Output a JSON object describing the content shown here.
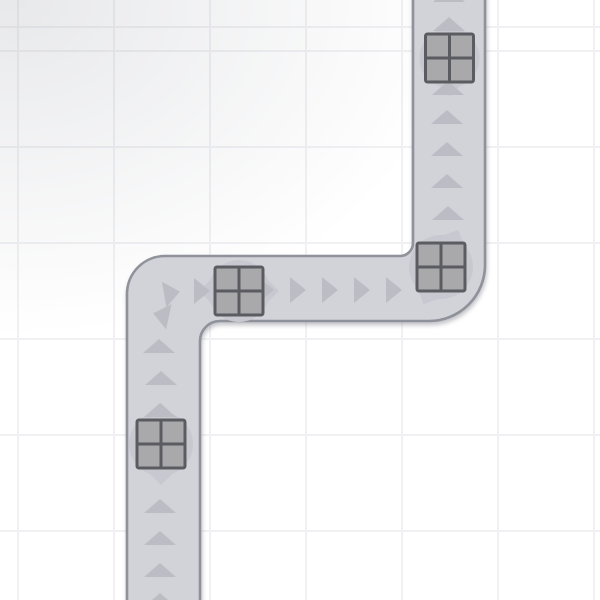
{
  "canvas": {
    "width": 600,
    "height": 600
  },
  "background": {
    "base_color": "#ffffff",
    "grid": {
      "cell_size": 96,
      "offset_x": 17,
      "offset_y": 50,
      "line_color": "#f1f1f4",
      "line_width": 2
    },
    "vignette": {
      "color": "rgba(118,122,136,0.17)",
      "cx_pct": 2,
      "cy_pct": 0,
      "rx_px": 640,
      "ry_px": 480
    }
  },
  "road": {
    "fill": "#d2d3d9",
    "border_color": "#8f919b",
    "border_width": 2.6,
    "shadow": "drop-shadow(1px 3px 2px rgba(96,99,112,0.38))",
    "path": "M 413 -10 L 413 243 A 13 13 0 0 1 400 256 L 165 256 A 38 38 0 0 0 127 294 L 127 610 L 200 610 L 200 341 A 20 20 0 0 1 220 321 L 429 321 A 56 56 0 0 0 485 265 L 485 -10 Z"
  },
  "arrows": {
    "color": "#bcbdc4",
    "shapes": {
      "up": "-16,7 0,-7 16,7",
      "right": "-8,-13 8,0 -8,13"
    },
    "items": [
      {
        "x": 449,
        "y": -5,
        "rot": 0,
        "shape": "up"
      },
      {
        "x": 449,
        "y": 24,
        "rot": 0,
        "shape": "up"
      },
      {
        "x": 448,
        "y": 88,
        "rot": 0,
        "shape": "up"
      },
      {
        "x": 447,
        "y": 117,
        "rot": 0,
        "shape": "up"
      },
      {
        "x": 447,
        "y": 149,
        "rot": 0,
        "shape": "up"
      },
      {
        "x": 447,
        "y": 181,
        "rot": 0,
        "shape": "up"
      },
      {
        "x": 448,
        "y": 213,
        "rot": 0,
        "shape": "up"
      },
      {
        "x": 394,
        "y": 290,
        "rot": 0,
        "shape": "right"
      },
      {
        "x": 362,
        "y": 290,
        "rot": 0,
        "shape": "right"
      },
      {
        "x": 330,
        "y": 290,
        "rot": 0,
        "shape": "right"
      },
      {
        "x": 298,
        "y": 290,
        "rot": 0,
        "shape": "right"
      },
      {
        "x": 266,
        "y": 290,
        "rot": 0,
        "shape": "right"
      },
      {
        "x": 202,
        "y": 291,
        "rot": 0,
        "shape": "right"
      },
      {
        "x": 172,
        "y": 293,
        "rot": -10,
        "shape": "right"
      },
      {
        "x": 161,
        "y": 315,
        "rot": 192,
        "shape": "right"
      },
      {
        "x": 159,
        "y": 346,
        "rot": 0,
        "shape": "up"
      },
      {
        "x": 161,
        "y": 378,
        "rot": 0,
        "shape": "up"
      },
      {
        "x": 160,
        "y": 410,
        "rot": 0,
        "shape": "up"
      },
      {
        "x": 160,
        "y": 506,
        "rot": 0,
        "shape": "up"
      },
      {
        "x": 160,
        "y": 538,
        "rot": 0,
        "shape": "up"
      },
      {
        "x": 160,
        "y": 570,
        "rot": 0,
        "shape": "up"
      },
      {
        "x": 160,
        "y": 600,
        "rot": 0,
        "shape": "up"
      }
    ]
  },
  "crates": {
    "blob_color": "#c8c9d0",
    "cell_color": "#a9a9ab",
    "line_color": "#5b5c61",
    "line_width": 3,
    "size": 48,
    "corner_radius": 2,
    "items": [
      {
        "x": 449.5,
        "y": 58,
        "angle": 0,
        "r": 30
      },
      {
        "x": 441,
        "y": 267,
        "angle": 25,
        "r": 32
      },
      {
        "x": 239,
        "y": 291,
        "angle": 90,
        "r": 31
      },
      {
        "x": 161,
        "y": 444,
        "angle": 0,
        "r": 32
      }
    ]
  }
}
